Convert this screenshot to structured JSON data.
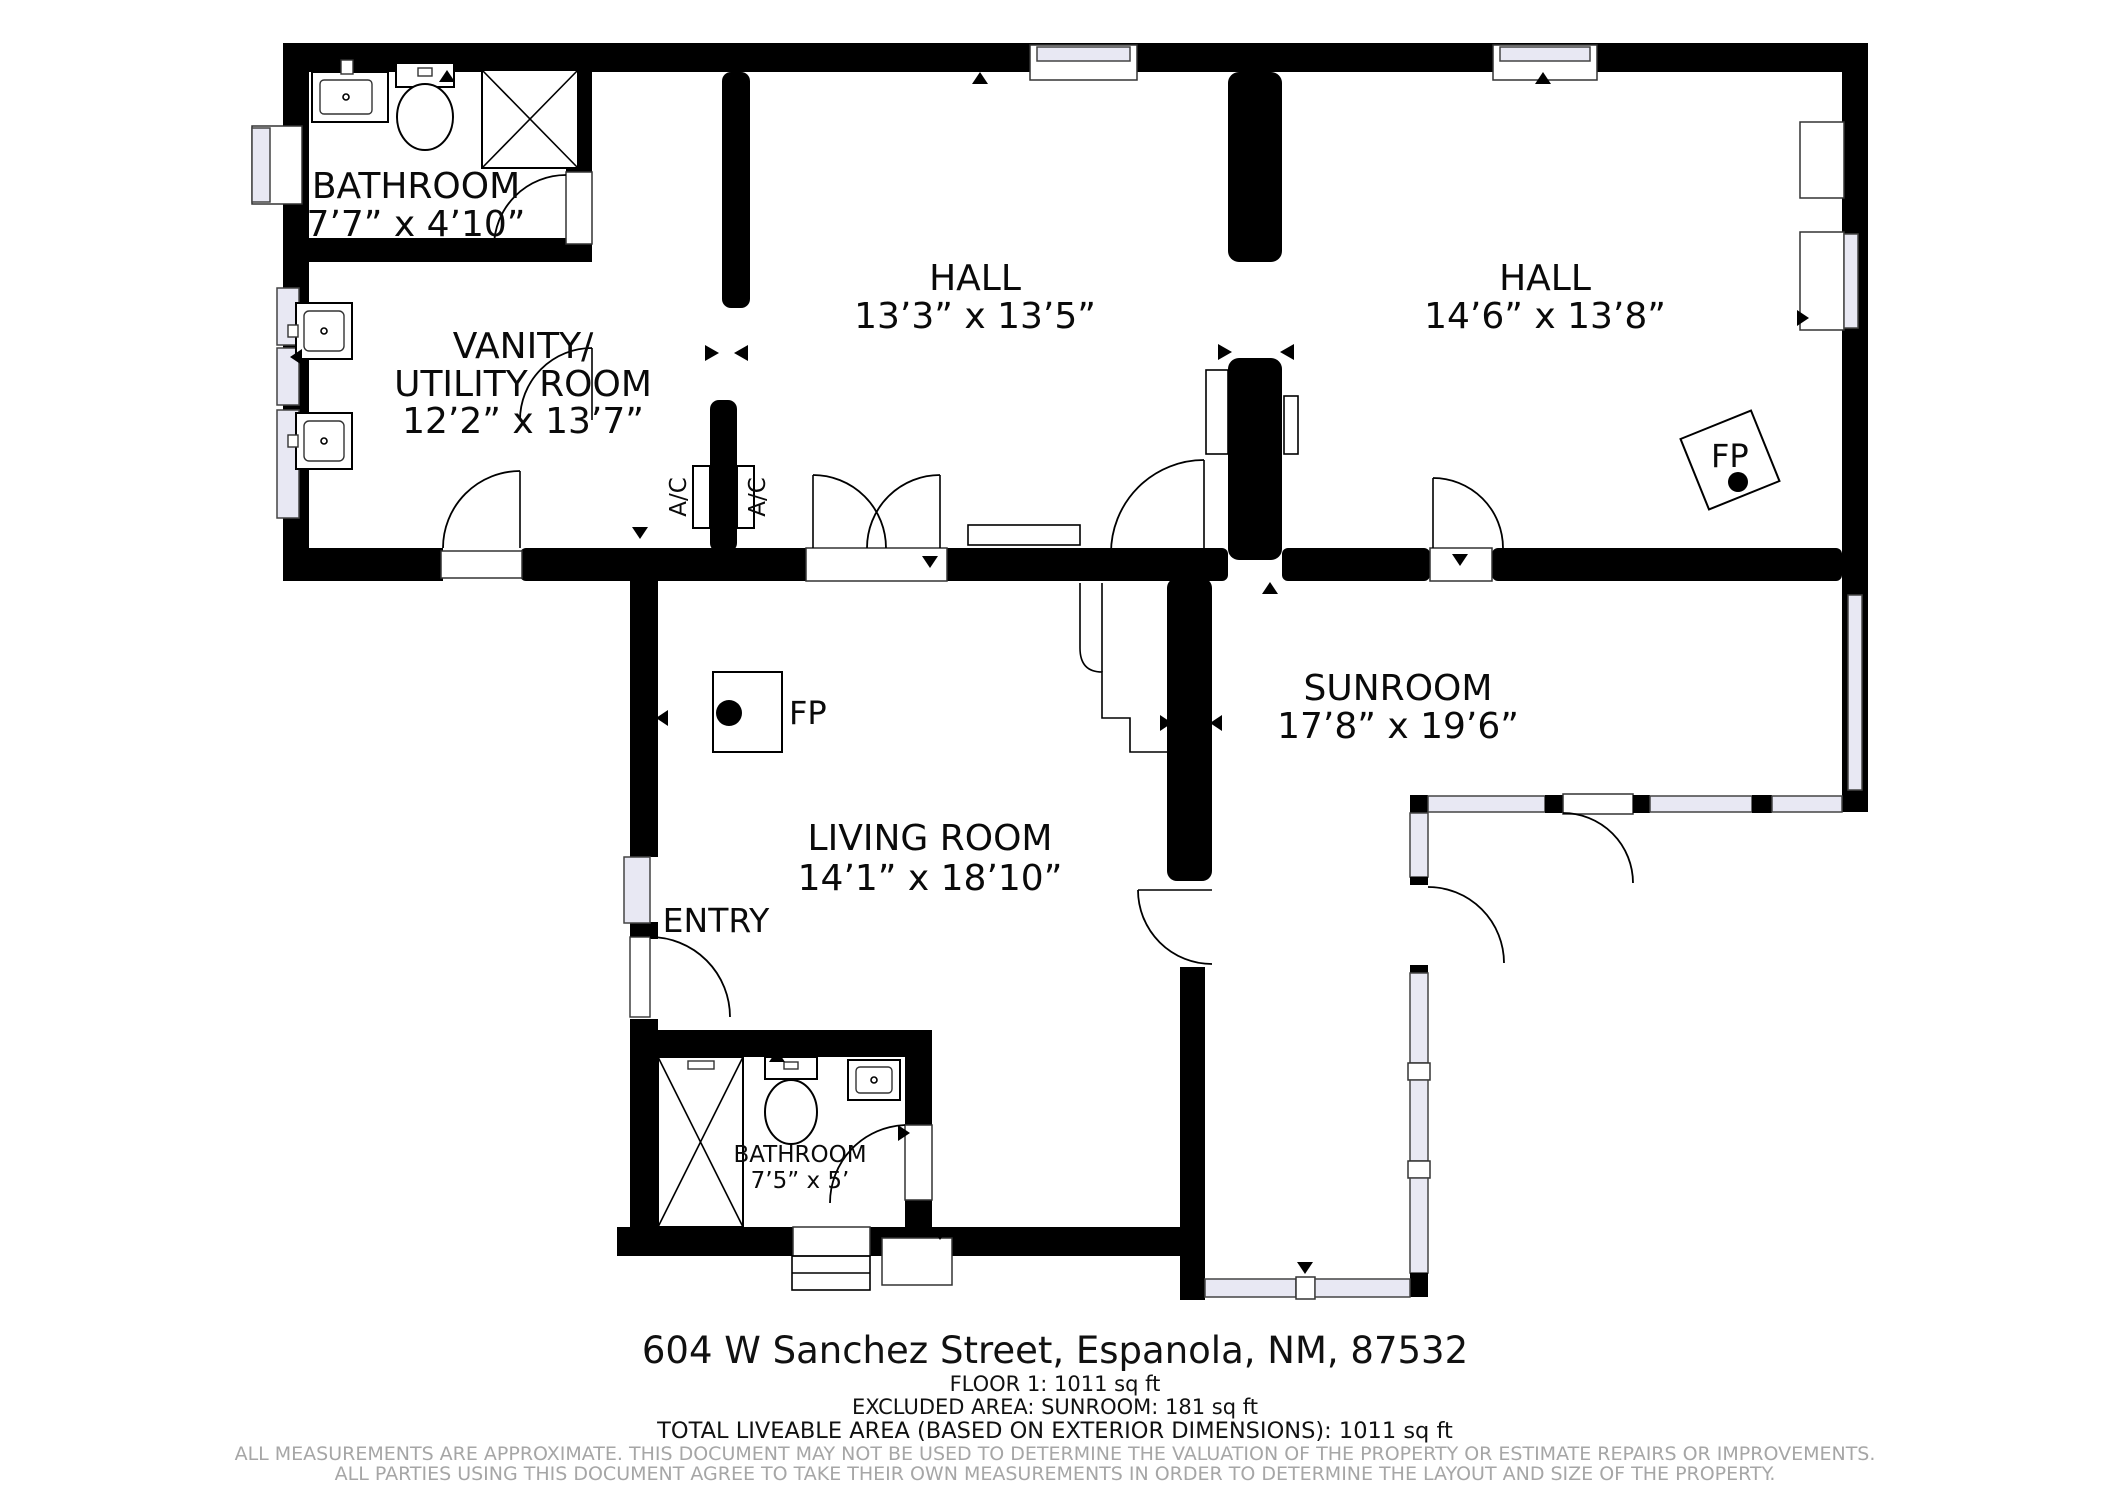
{
  "rooms": {
    "bathroom1": {
      "name": "BATHROOM",
      "dims": "7’7” x 4’10”"
    },
    "vanity": {
      "name_line1": "VANITY/",
      "name_line2": "UTILITY ROOM",
      "dims": "12’2” x 13’7”"
    },
    "hall_left": {
      "name": "HALL",
      "dims": "13’3” x 13’5”"
    },
    "hall_right": {
      "name": "HALL",
      "dims": "14’6” x 13’8”"
    },
    "living": {
      "name": "LIVING ROOM",
      "dims": "14’1” x 18’10”"
    },
    "sunroom": {
      "name": "SUNROOM",
      "dims": "17’8” x 19’6”"
    },
    "bathroom2": {
      "name": "BATHROOM",
      "dims": "7’5” x 5’"
    },
    "entry": {
      "name": "ENTRY"
    }
  },
  "labels": {
    "fireplace": "FP",
    "ac": "A/C"
  },
  "footer": {
    "address": "604 W Sanchez Street, Espanola, NM, 87532",
    "floor": "FLOOR 1: 1011 sq ft",
    "excluded": "EXCLUDED AREA: SUNROOM: 181 sq ft",
    "total": "TOTAL LIVEABLE AREA (BASED ON EXTERIOR DIMENSIONS): 1011 sq ft",
    "disclaimer1": "ALL MEASUREMENTS ARE APPROXIMATE. THIS DOCUMENT MAY NOT BE USED TO DETERMINE THE VALUATION OF THE PROPERTY OR ESTIMATE REPAIRS OR IMPROVEMENTS.",
    "disclaimer2": "ALL PARTIES USING THIS DOCUMENT AGREE TO TAKE THEIR OWN MEASUREMENTS IN ORDER TO DETERMINE THE LAYOUT AND SIZE OF THE PROPERTY."
  },
  "colors": {
    "wall": "#000000",
    "line": "#000000",
    "window": "#e8e8f3",
    "disclaimer": "#a6a6a6",
    "background": "#ffffff"
  }
}
